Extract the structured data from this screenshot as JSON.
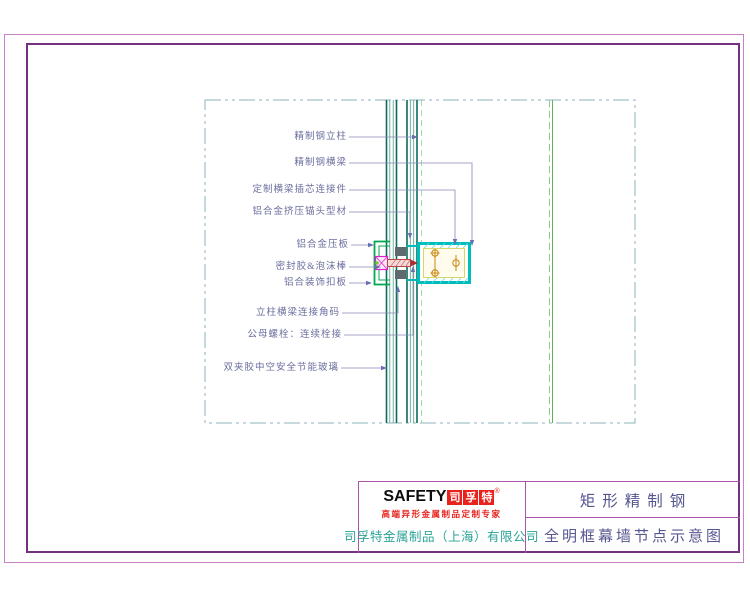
{
  "drawing": {
    "labels": [
      "精制钢立柱",
      "精制钢横梁",
      "定制横梁插芯连接件",
      "铝合金挤压锚头型材",
      "铝合金压板",
      "密封胶&泡沫棒",
      "铝合装饰扣板",
      "立柱横梁连接角码",
      "公母螺栓：连续栓接",
      "双夹胶中空安全节能玻璃"
    ]
  },
  "title_block": {
    "logo_safety": "SAFETY",
    "logo_cn_chars": [
      "司",
      "孚",
      "特"
    ],
    "logo_reg": "®",
    "tagline": "高端异形金属制品定制专家",
    "company": "司孚特金属制品（上海）有限公司",
    "product": "矩形精制钢",
    "drawing_title": "全明框幕墙节点示意图"
  },
  "colors": {
    "frame_outer": "#c583c5",
    "frame_inner": "#73317f",
    "title_block_lines": "#aa55aa",
    "brand_red": "#e8231d",
    "company_teal": "#2aa396",
    "title_text": "#565690",
    "callout_text": "#6a6d9e",
    "boundary_dashdot": "#8cb6be",
    "mullion_dark": "#0d6b5d",
    "mullion_light": "#4f9f85",
    "hidden_green": "#8fcc8f",
    "beam_cyan": "#00bdbd",
    "beam_yellow": "#d6d66a",
    "bolt_orange": "#c8860a",
    "clamp_green": "#00a84e",
    "bolt_magenta": "#dd22cc",
    "bolt_red": "#c04545"
  }
}
